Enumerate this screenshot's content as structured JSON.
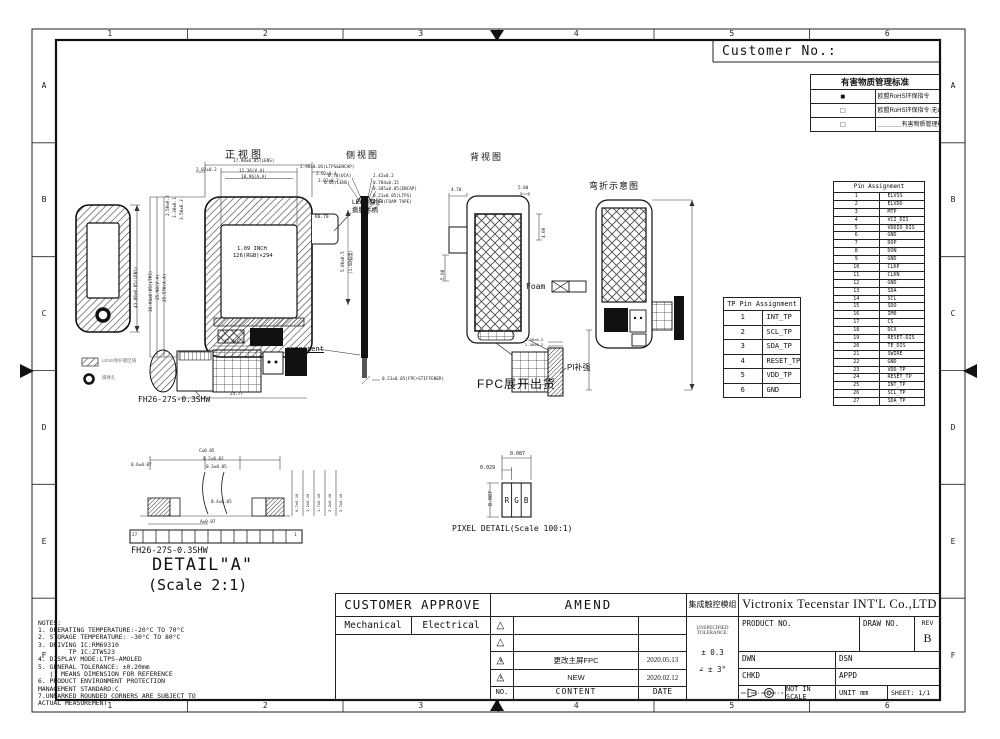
{
  "frame": {
    "customer_no": "Customer No.:",
    "cols": [
      "1",
      "2",
      "3",
      "4",
      "5",
      "6"
    ],
    "rows": [
      "A",
      "B",
      "C",
      "D",
      "E",
      "F"
    ]
  },
  "rohs": {
    "title": "有害物质管理标准",
    "rows": [
      {
        "box": "■",
        "label": "欧盟RoHS环保指令"
      },
      {
        "box": "□",
        "label": "欧盟RoHS环保指令·无卤素要求"
      },
      {
        "box": "□",
        "label": "＿＿＿＿有害物质管理标准  第＿＿版"
      }
    ]
  },
  "views": {
    "front": {
      "title": "正视图",
      "dims_top": [
        "2.02±0.2",
        "17.80±0.05(LENS)",
        "2.96±0.05(LTPS&ENCAP)",
        "11.36(V.A)",
        "10.96(A.A)",
        "2.02±0.1",
        "3.02±0.2"
      ],
      "dims_left_small": [
        "2.50±0.2",
        "3.30±0.1",
        "3.50±0.2"
      ],
      "dims_left_rot": [
        "36.94±0.05(LTPS)",
        "25.98(V.A)",
        "25.578(A.A)"
      ],
      "display_line1": "1.09 INCH",
      "display_line2": "126(RGB)×294",
      "radius": "R0.70",
      "lens_note1": "LENS保护",
      "lens_note2": "撕膜手柄",
      "dim_fpc_w": "12.0±0.2",
      "dim_total_w": "24.77",
      "connector": "FH26-27S-0.3SHW",
      "component": "component"
    },
    "phone": {
      "dim_rot": "43.80±0.05(LENS)",
      "legend1": "LENS保护膜区域",
      "legend2": "摄像孔"
    },
    "side": {
      "title": "侧视图",
      "dims_right": [
        "2.42±0.2",
        "0.784±0.15",
        "0.305±0.05(ENCAP)",
        "0.21±0.05(LTPS)",
        "0.13(FOAM TAPE)"
      ],
      "dims_left": [
        "0.70(OCA)",
        "0.05(LENS)"
      ],
      "dim_rot1": "5.80±0.5",
      "dim_rot2": "(1.5D弧度)",
      "dim_bottom": "0.21±0.05(FPC+STIFFENER)"
    },
    "back": {
      "title": "背视图",
      "dim1": "4.70",
      "dim2": "5.00",
      "dim3": "4.00",
      "dim4": "5.08",
      "foam": "Foam"
    },
    "bend": {
      "title": "弯折示意图"
    },
    "fpc": {
      "title": "FPC展开出货",
      "pi": "PI补强",
      "dim1": "2.50±0.2",
      "dim2": "2.40±0.2"
    },
    "pixel": {
      "title": "PIXEL DETAIL(Scale 100:1)",
      "subpixels": [
        "R",
        "G",
        "B"
      ],
      "dim_w": "0.087",
      "dim_sub": "0.029",
      "dim_h": "0.087"
    },
    "detail": {
      "line1": "DETAIL\"A\"",
      "line2": "(Scale 2:1)",
      "connector": "FH26-27S-0.3SHW",
      "pin_left": "27",
      "pin_right": "1",
      "dims": [
        "0.6±0.07",
        "C±0.05",
        "0.2±0.02",
        "0.3±0.05",
        "0.4±0.05",
        "A±0.07"
      ],
      "dims_rot": [
        "0.7±0.10",
        "1.2±0.10",
        "1.7±0.10",
        "2.2±0.10",
        "2.7±0.10"
      ]
    }
  },
  "tp_table": {
    "title": "TP Pin Assignment",
    "pins": [
      "INT_TP",
      "SCL_TP",
      "SDA_TP",
      "RESET_TP",
      "VDD_TP",
      "GND"
    ]
  },
  "pin_table": {
    "title": "Pin Assignment",
    "pins": [
      "ELVSS",
      "ELVDD",
      "MTP",
      "VCI_DIS",
      "VDDIO_DIS",
      "GND",
      "DOP",
      "DON",
      "GND",
      "CLKP",
      "CLKN",
      "GND",
      "SDA",
      "SCL",
      "SDO",
      "IM0",
      "CS",
      "DCX",
      "RESET-DIS",
      "TE_DIS",
      "SWIRE",
      "GND",
      "VDD_TP",
      "RESET_TP",
      "INT_TP",
      "SCL_TP",
      "SDA_TP"
    ]
  },
  "notes": {
    "lines": [
      "NOTES:",
      "1. OPERATING TEMPERATURE:-20°C TO 70°C",
      "2. STORAGE TEMPERATURE: -30°C TO 80°C",
      "3. DRIVING IC:RM69310",
      "        TP IC:ZTW523",
      "4. DISPLAY MODE:LTPS-AMOLED",
      "5. GENERAL TOLERANCE: ±0.20mm",
      "   () MEANS DIMENSION FOR REFERENCE",
      "6. PRODUCT ENVIRONMENT PROTECTION",
      "MANAGEMENT STANDARD:C",
      "7.UNMARKED ROUNDED CORNERS ARE SUBJECT TO",
      "ACTUAL MEASUREMENT"
    ]
  },
  "approve": {
    "title": "CUSTOMER APPROVE",
    "col1": "Mechanical",
    "col2": "Electrical"
  },
  "amend": {
    "title": "AMEND",
    "rows": [
      {
        "mark": "",
        "content": "",
        "date": ""
      },
      {
        "mark": "",
        "content": "",
        "date": ""
      },
      {
        "mark": "B",
        "content": "更改主屏FPC",
        "date": "2020.05.13"
      },
      {
        "mark": "A",
        "content": "NEW",
        "date": "2020.02.12"
      }
    ],
    "footer": {
      "no": "NO.",
      "content": "CONTENT",
      "date": "DATE"
    }
  },
  "module_type": "集成触控模组",
  "tolerance": {
    "l1": "UNSPECIFIED",
    "l2": "TOLERANCE:",
    "v1": "± 0.3",
    "v2": "∠ ± 3°"
  },
  "title_block": {
    "company": "Victronix Tecenstar INT'L Co.,LTD",
    "product_no": "PRODUCT NO.",
    "draw_no": "DRAW NO.",
    "rev": "REV",
    "rev_value": "B",
    "dwn": "DWN",
    "dsn": "DSN",
    "chkd": "CHKD",
    "appd": "APPD",
    "scale": "NOT IN SCALE",
    "unit": "UNIT mm",
    "sheet": "SHEET: 1/1"
  }
}
